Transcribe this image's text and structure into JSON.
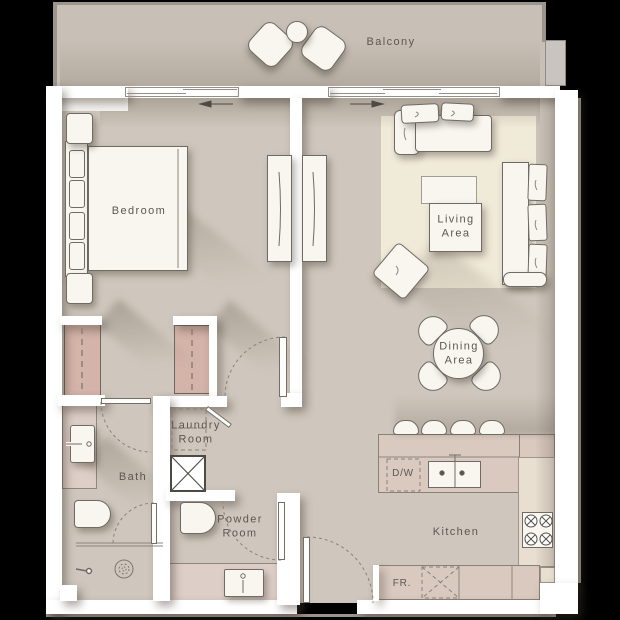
{
  "plan_title": "One-bedroom apartment floor plan",
  "labels": {
    "balcony": "Balcony",
    "bedroom": "Bedroom",
    "living_area": "Living\nArea",
    "dining_area": "Dining\nArea",
    "bath": "Bath",
    "laundry_room": "Laundry\nRoom",
    "powder_room": "Powder\nRoom",
    "kitchen": "Kitchen",
    "dishwasher": "D/W",
    "fridge": "FR."
  },
  "colors": {
    "floor": "#cfc7bd",
    "balcony": "#c8c0b6",
    "rug": "#f0ead9",
    "closet": "#d4b3a8",
    "counter": "#d9c9bf",
    "cream": "#e8dfd1",
    "vanity": "#ddcfc7",
    "wall": "#ffffff",
    "furniture": "#f8f6ef",
    "outline": "#6f6b64",
    "text": "#5b5751",
    "rail": "#9b958d",
    "column": "#c9c4bf",
    "background": "#000000"
  }
}
